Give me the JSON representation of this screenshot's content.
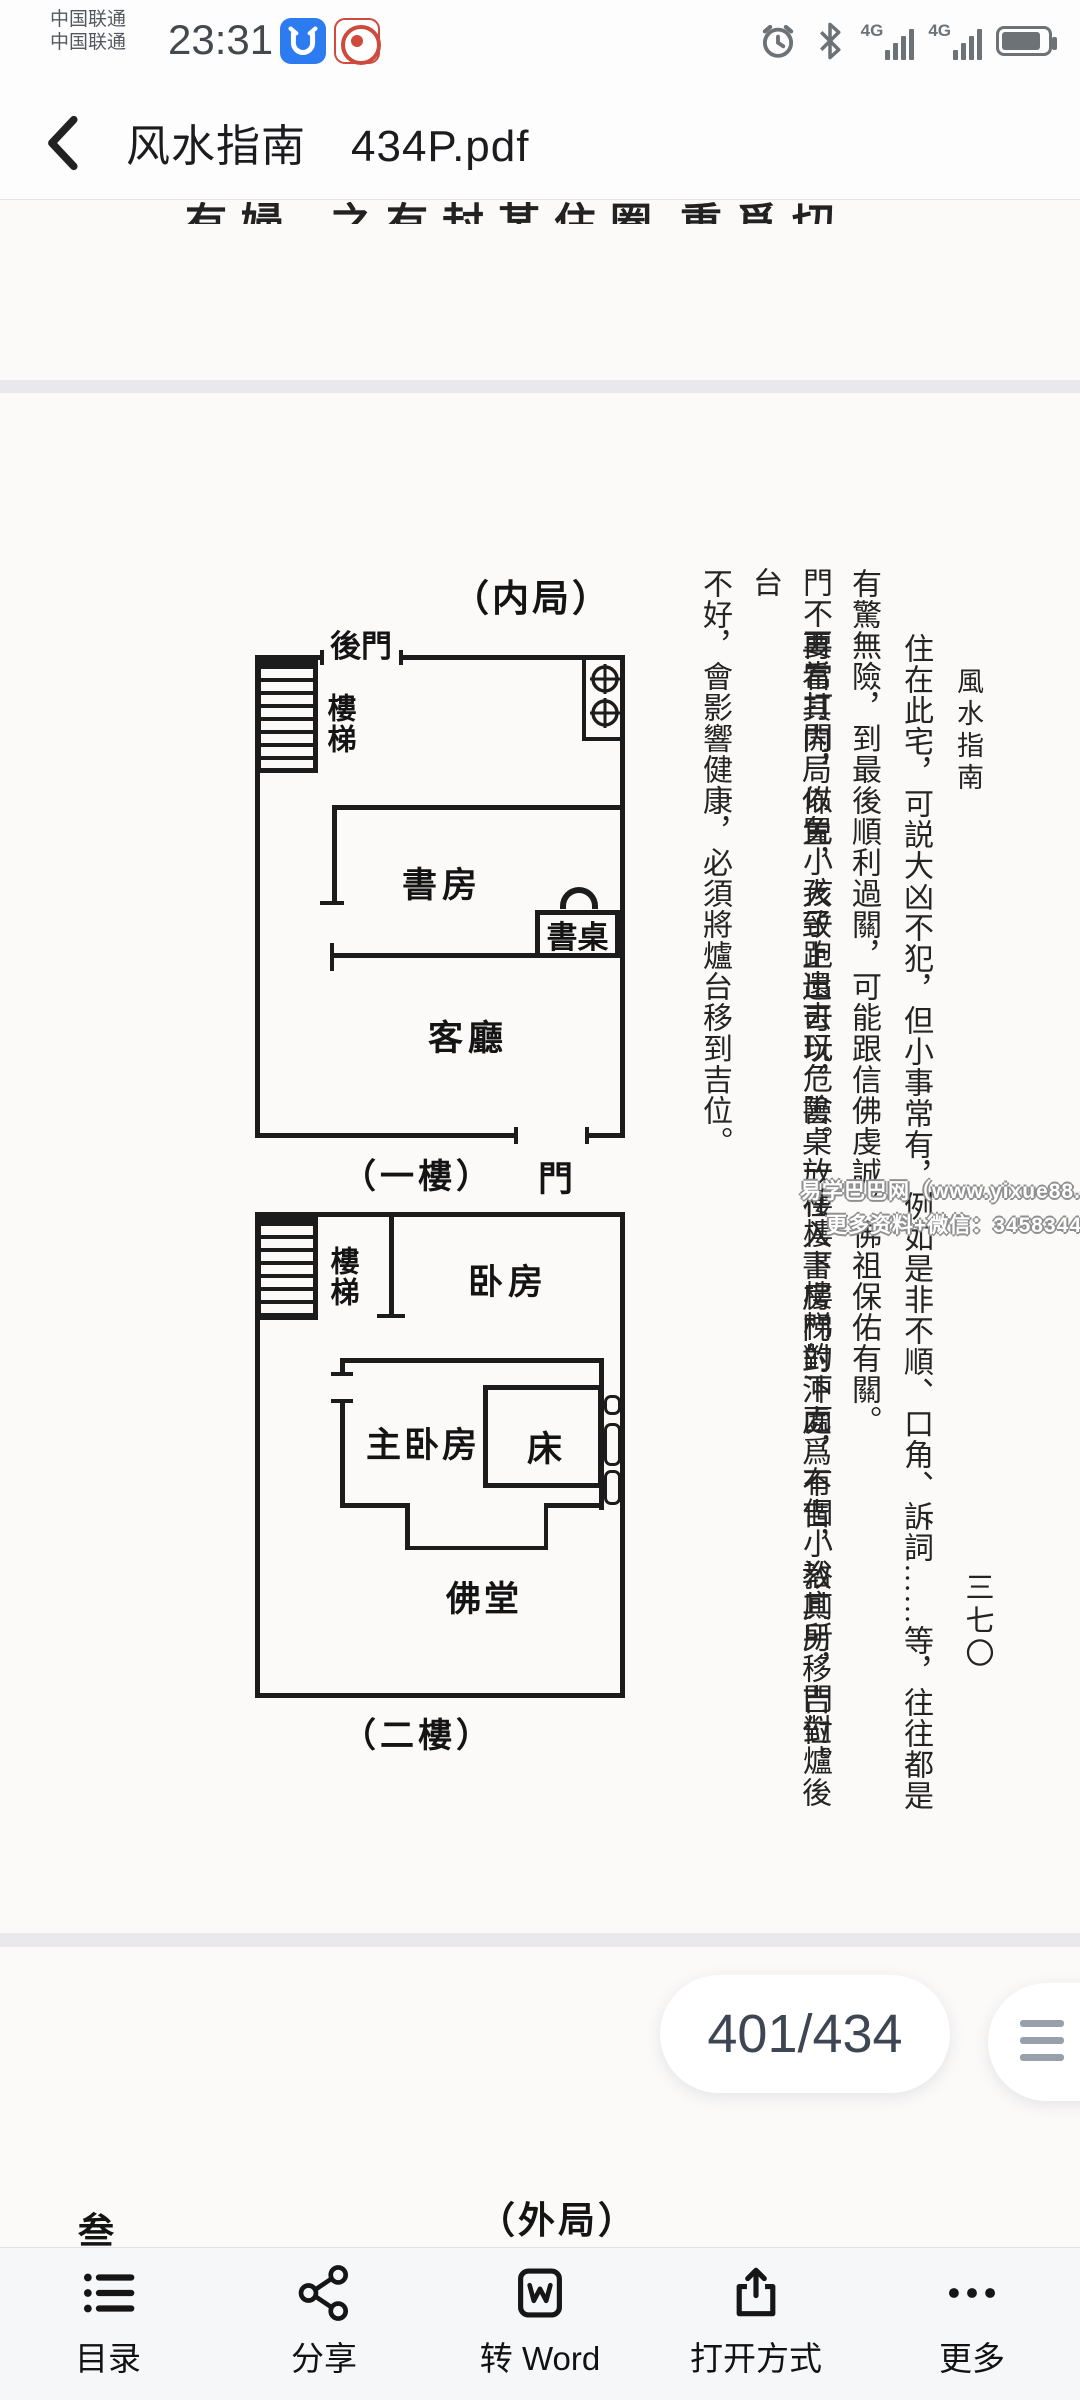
{
  "status_bar": {
    "carrier_line1": "中国联通",
    "carrier_line2": "中国联通",
    "time": "23:31",
    "network1": "4G",
    "network2": "4G"
  },
  "header": {
    "title": "风水指南　434P.pdf"
  },
  "prev_page": {
    "fragments": [
      "有婦",
      "之有封某住圈",
      "重爲切"
    ]
  },
  "page": {
    "book_header": "風水指南",
    "section_title": "（内局）",
    "page_number_cn": "三七〇",
    "columns": [
      "住在此宅，可説大凶不犯，但小事常有，例如是非不順、口角、訴詞……等，往往都是",
      "有驚無險，到最後順利過關，可能跟信佛虔誠，佛祖保佑有關。",
      "再看其内局佈置，大致上還可以，書桌放在入書房門對沖處爲不吉，教其另移吉位。後",
      "門不要常打開，以免小孩子跑出去玩危險。一樓樓下樓梯的下面，有個小浴廁所，門對爐台",
      "不好，會影響健康，必須將爐台移到吉位。"
    ],
    "floor1": {
      "back_door": "後門",
      "stairs": "樓梯",
      "study": "書房",
      "desk": "書桌",
      "living_room": "客廳",
      "door": "門",
      "caption": "（一樓）"
    },
    "floor2": {
      "stairs": "樓梯",
      "bedroom": "卧房",
      "master_bedroom": "主卧房",
      "bed": "床",
      "altar": "佛堂",
      "caption": "（二樓）"
    },
    "watermark": {
      "line1": "易学巴巴网（www.yixue88.cn",
      "line2": "更多资料+微信：3458344044"
    }
  },
  "next_page": {
    "fragment": "叁",
    "section_title": "（外局）"
  },
  "pager": {
    "label": "401/434"
  },
  "toolbar": {
    "items": [
      {
        "label": "目录"
      },
      {
        "label": "分享"
      },
      {
        "label": "转 Word"
      },
      {
        "label": "打开方式"
      },
      {
        "label": "更多"
      }
    ]
  }
}
